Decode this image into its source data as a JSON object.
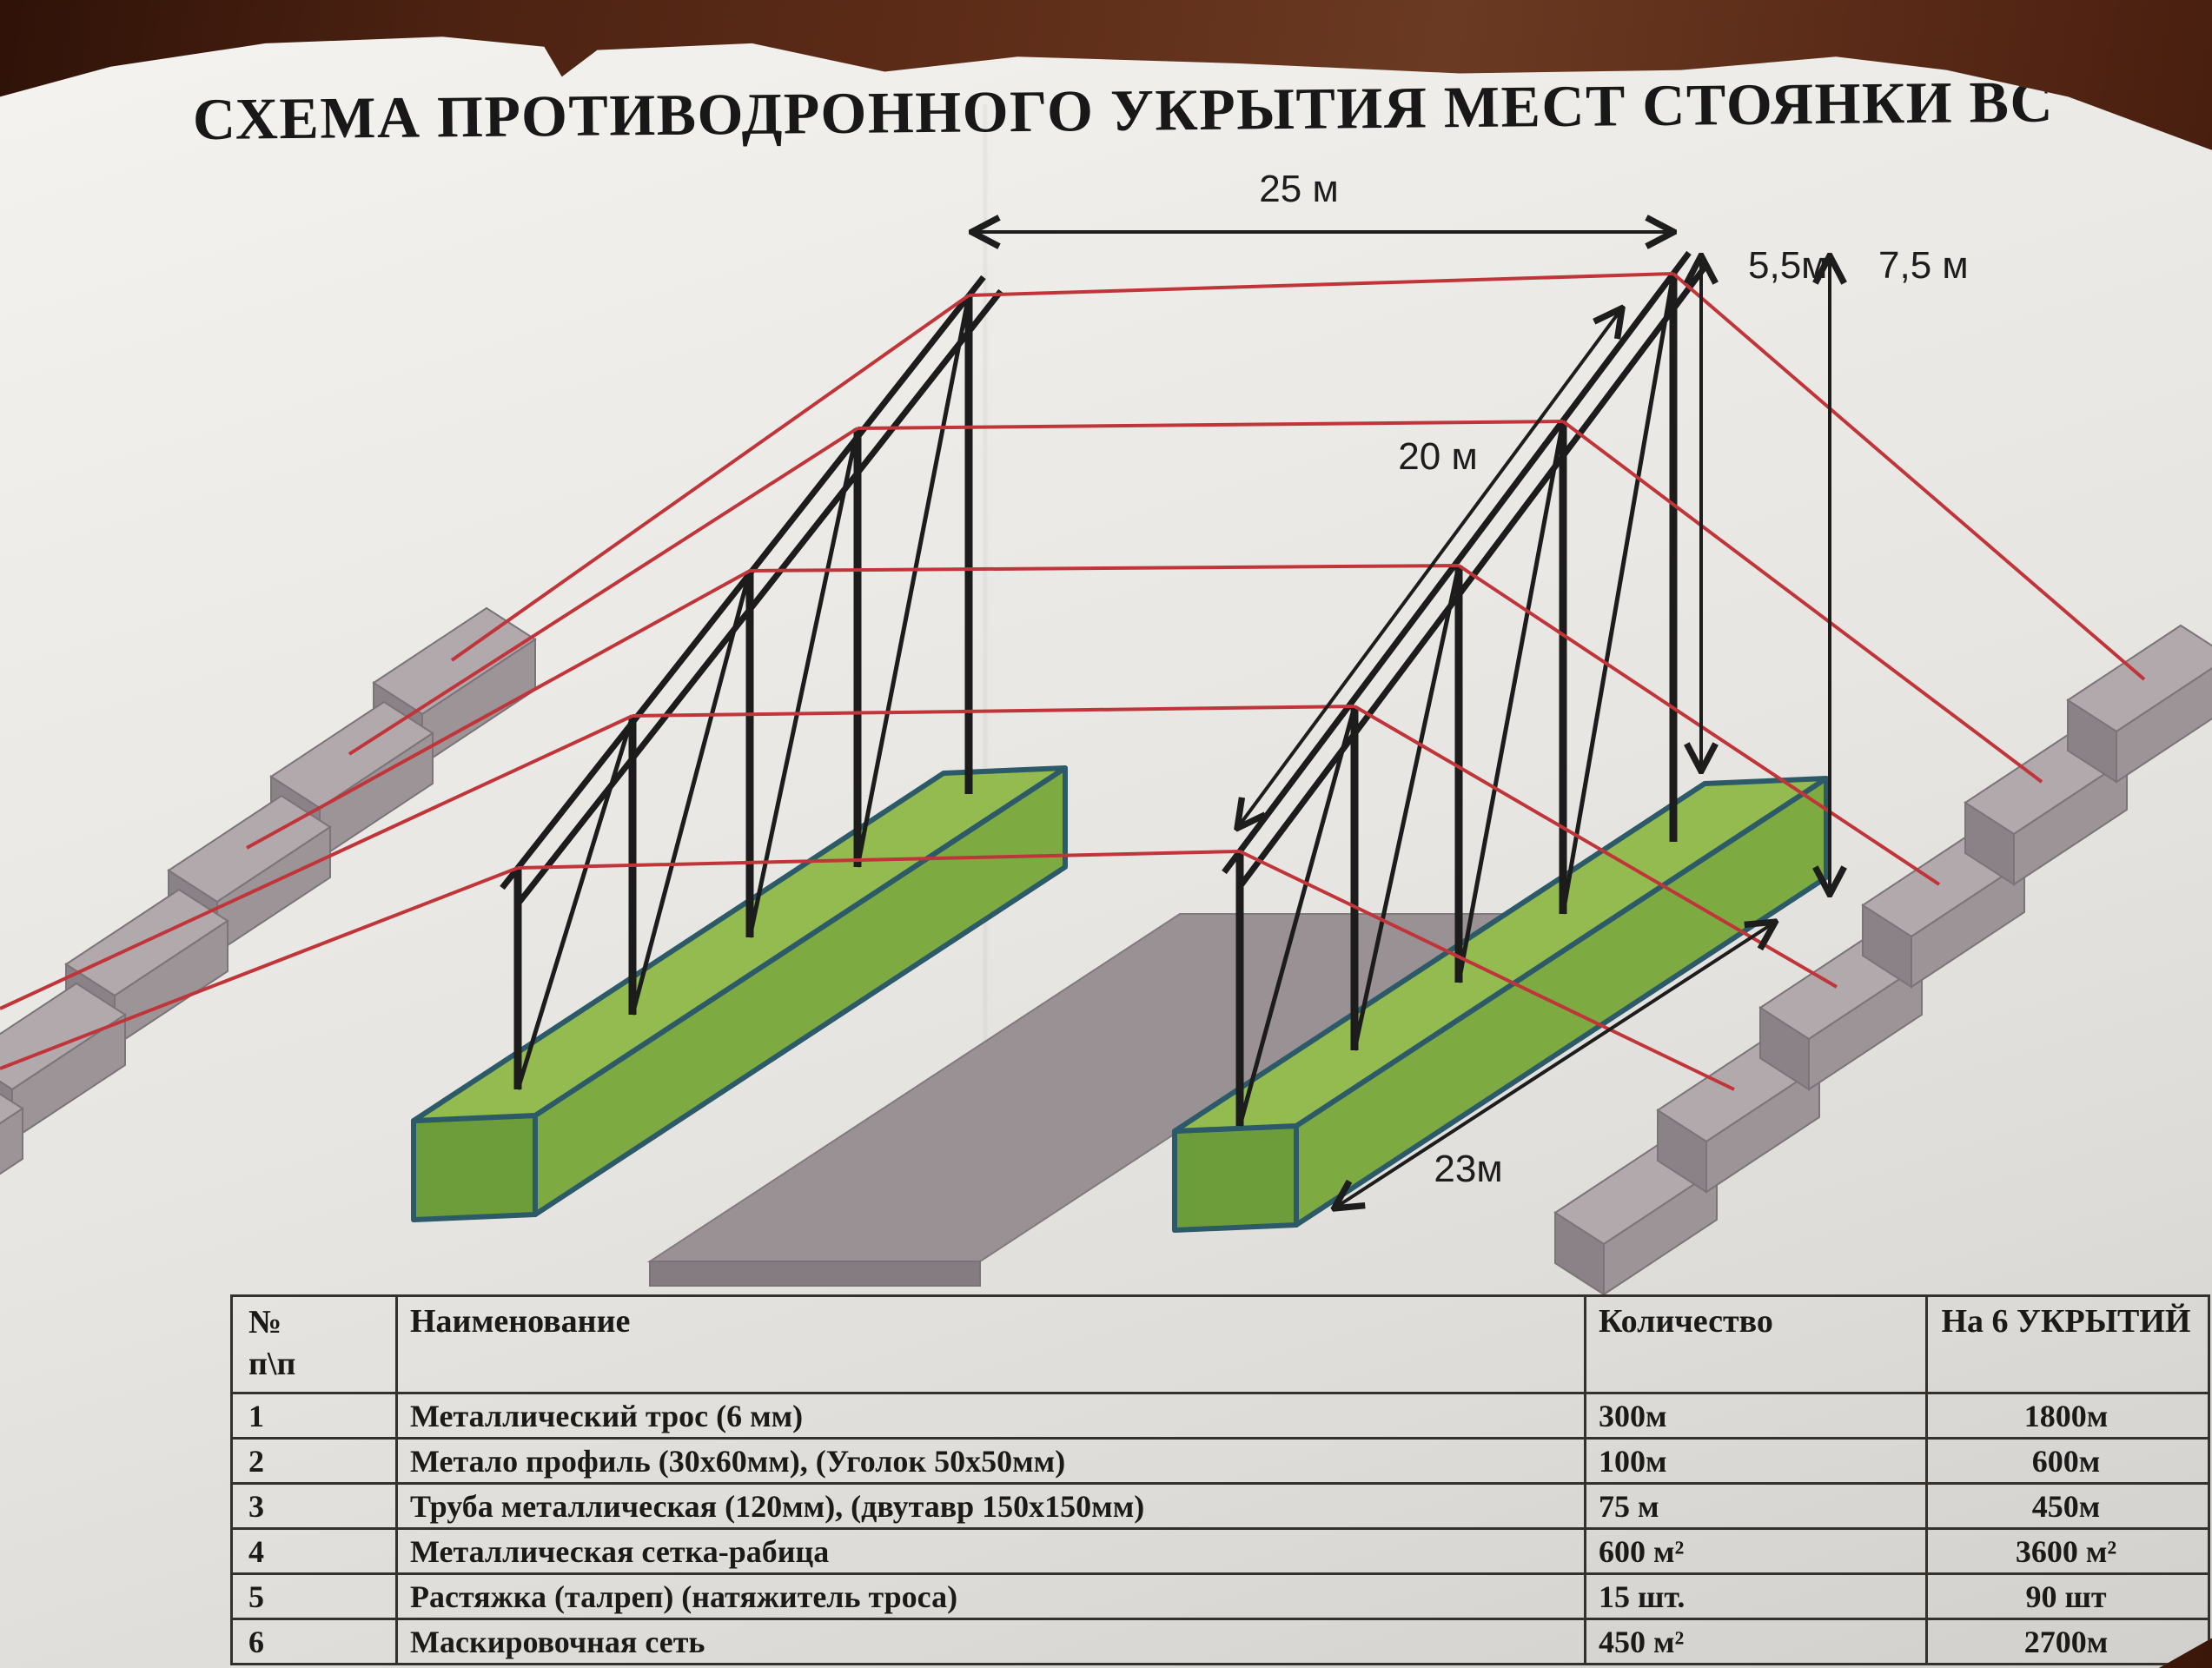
{
  "title": "СХЕМА ПРОТИВОДРОННОГО УКРЫТИЯ МЕСТ СТОЯНКИ ВС",
  "diagram": {
    "dim_width": "25 м",
    "dim_pole_height": "5,5м",
    "dim_total_height": "7,5 м",
    "dim_length": "20 м",
    "dim_anchor_span": "23м",
    "colors": {
      "cable_red": "#c0353a",
      "frame_black": "#1e1e1e",
      "shelter_green_top": "#93bb4f",
      "shelter_green_side": "#7dab41",
      "shelter_green_front": "#6d9c3a",
      "shelter_outline_teal": "#2c5a68",
      "anchor_block_gray": "#b2a9ad",
      "slab_gray": "#9a9195",
      "paper": "#ebe9e5",
      "wood_table": "#5d2c18"
    }
  },
  "table": {
    "headers": {
      "num": "№\nп\\п",
      "name": "Наименование",
      "qty": "Количество",
      "total": "На 6 УКРЫТИЙ"
    },
    "rows": [
      {
        "num": "1",
        "name": "Металлический трос (6 мм)",
        "qty": "300м",
        "total": "1800м"
      },
      {
        "num": "2",
        "name": "Метало профиль (30х60мм), (Уголок 50х50мм)",
        "qty": "100м",
        "total": "600м"
      },
      {
        "num": "3",
        "name": "Труба металлическая (120мм), (двутавр 150х150мм)",
        "qty": "75 м",
        "total": "450м"
      },
      {
        "num": "4",
        "name": "Металлическая сетка-рабица",
        "qty": "600 м²",
        "total": "3600 м²"
      },
      {
        "num": "5",
        "name": "Растяжка (талреп) (натяжитель троса)",
        "qty": "15 шт.",
        "total": "90 шт"
      },
      {
        "num": "6",
        "name": "Маскировочная сеть",
        "qty": "450 м²",
        "total": "2700м"
      }
    ]
  }
}
